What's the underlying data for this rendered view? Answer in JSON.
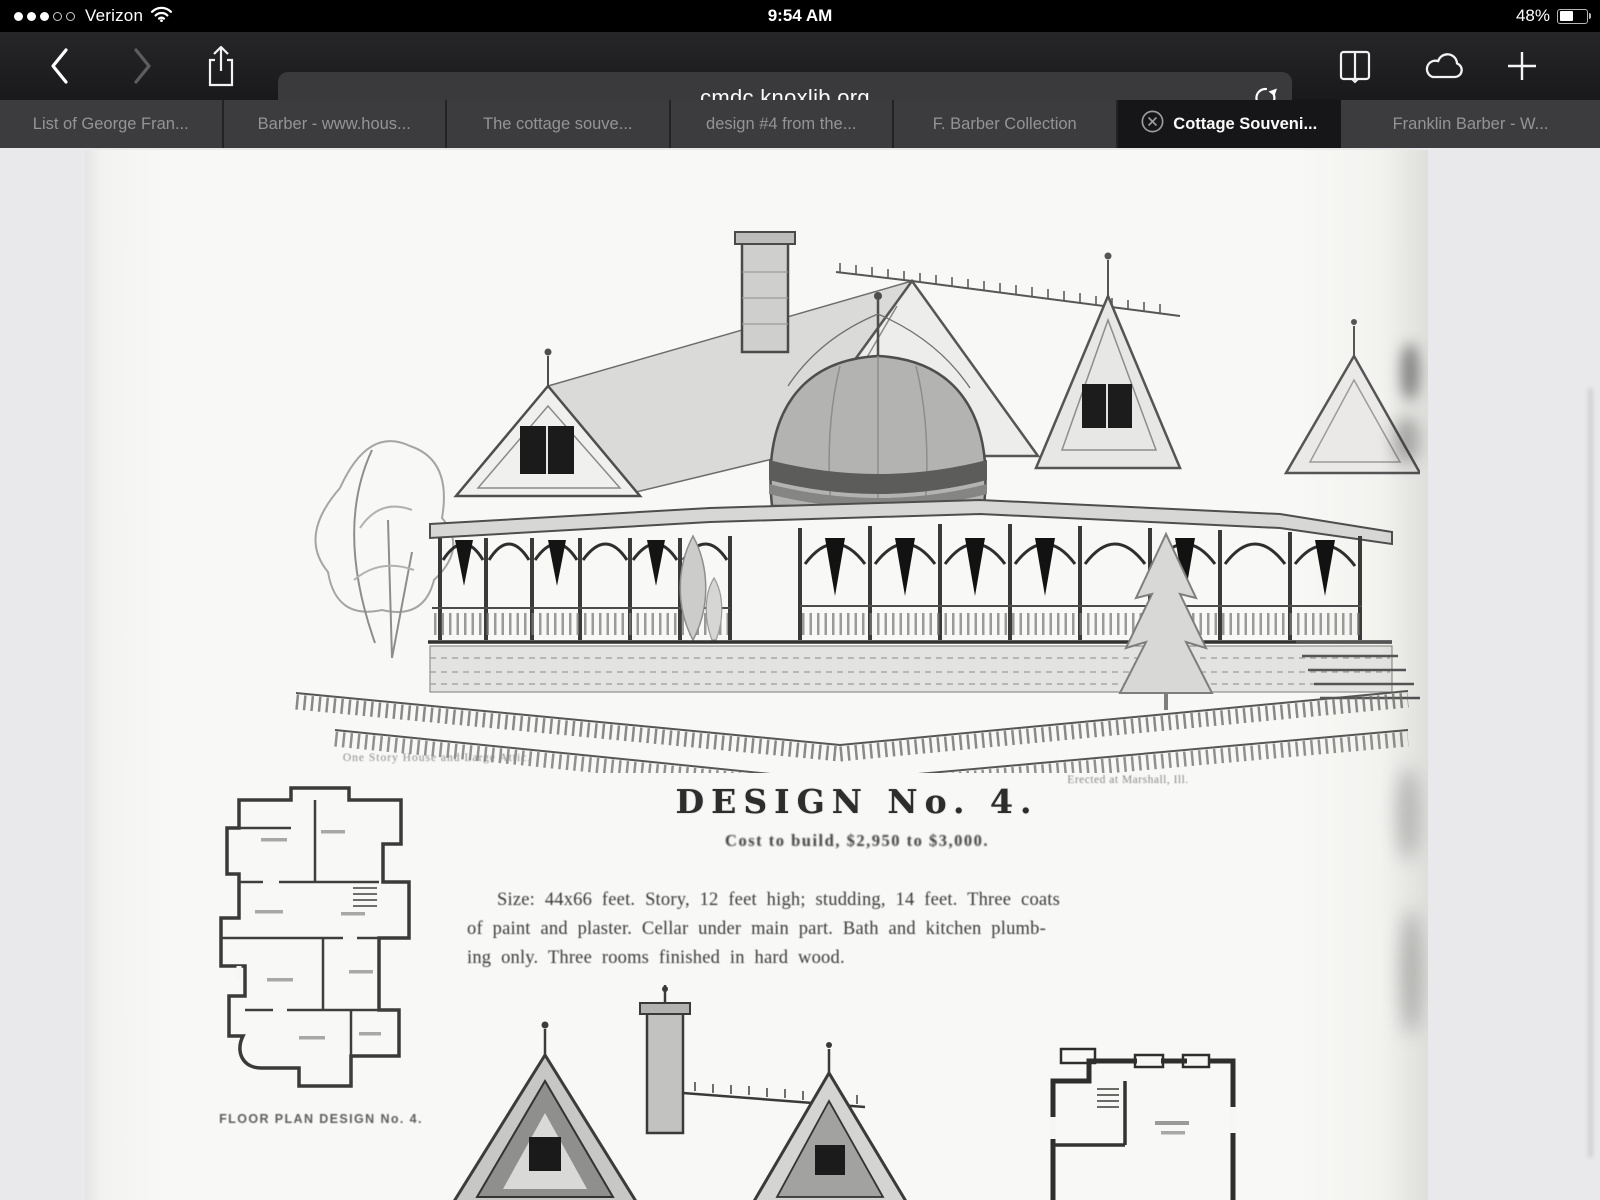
{
  "status_bar": {
    "carrier": "Verizon",
    "time": "9:54 AM",
    "battery_percent": "48%"
  },
  "toolbar": {
    "url": "cmdc.knoxlib.org"
  },
  "tab_bar": {
    "tabs": [
      {
        "label": "List of George Fran...",
        "active": false
      },
      {
        "label": "Barber - www.hous...",
        "active": false
      },
      {
        "label": "The cottage souve...",
        "active": false
      },
      {
        "label": "design #4 from the...",
        "active": false
      },
      {
        "label": "F. Barber Collection",
        "active": false
      },
      {
        "label": "Cottage Souveni...",
        "active": true,
        "closable": true
      },
      {
        "label": "Franklin Barber - W...",
        "active": false
      }
    ]
  },
  "document_page": {
    "plan_caption": "One Story House and Large Attic.",
    "location_caption": "Erected at Marshall, Ill.",
    "title": "DESIGN No. 4.",
    "cost": "Cost to build, $2,950 to $3,000.",
    "description_lines": [
      "Size: 44x66 feet.  Story, 12 feet high; studding, 14 feet.  Three coats",
      "of paint and plaster.  Cellar under main part.  Bath and kitchen plumb-",
      "ing only.  Three rooms finished in hard wood."
    ],
    "floor_plan_label": "FLOOR PLAN DESIGN No. 4."
  },
  "icons": {
    "cellular_signal": "3-of-5-dots",
    "wifi": "wifi-arcs",
    "battery": "battery-48-percent",
    "back": "chevron-left",
    "forward": "chevron-right",
    "share": "box-arrow-up",
    "reload": "circular-arrow",
    "bookmarks": "open-book",
    "icloud_tabs": "cloud",
    "new_tab": "plus",
    "close_tab": "circle-x"
  },
  "colors": {
    "status_bg": "#000000",
    "chrome_bg": "#1d1d1f",
    "url_field_bg": "#3a3a3c",
    "tab_inactive_bg": "#3c3c3e",
    "tab_active_bg": "#161618",
    "tab_text": "#949496",
    "tab_active_text": "#fafafa",
    "content_bg": "#e9e9eb",
    "page_bg": "#f7f7f5",
    "ink": "#2d2d2d"
  }
}
